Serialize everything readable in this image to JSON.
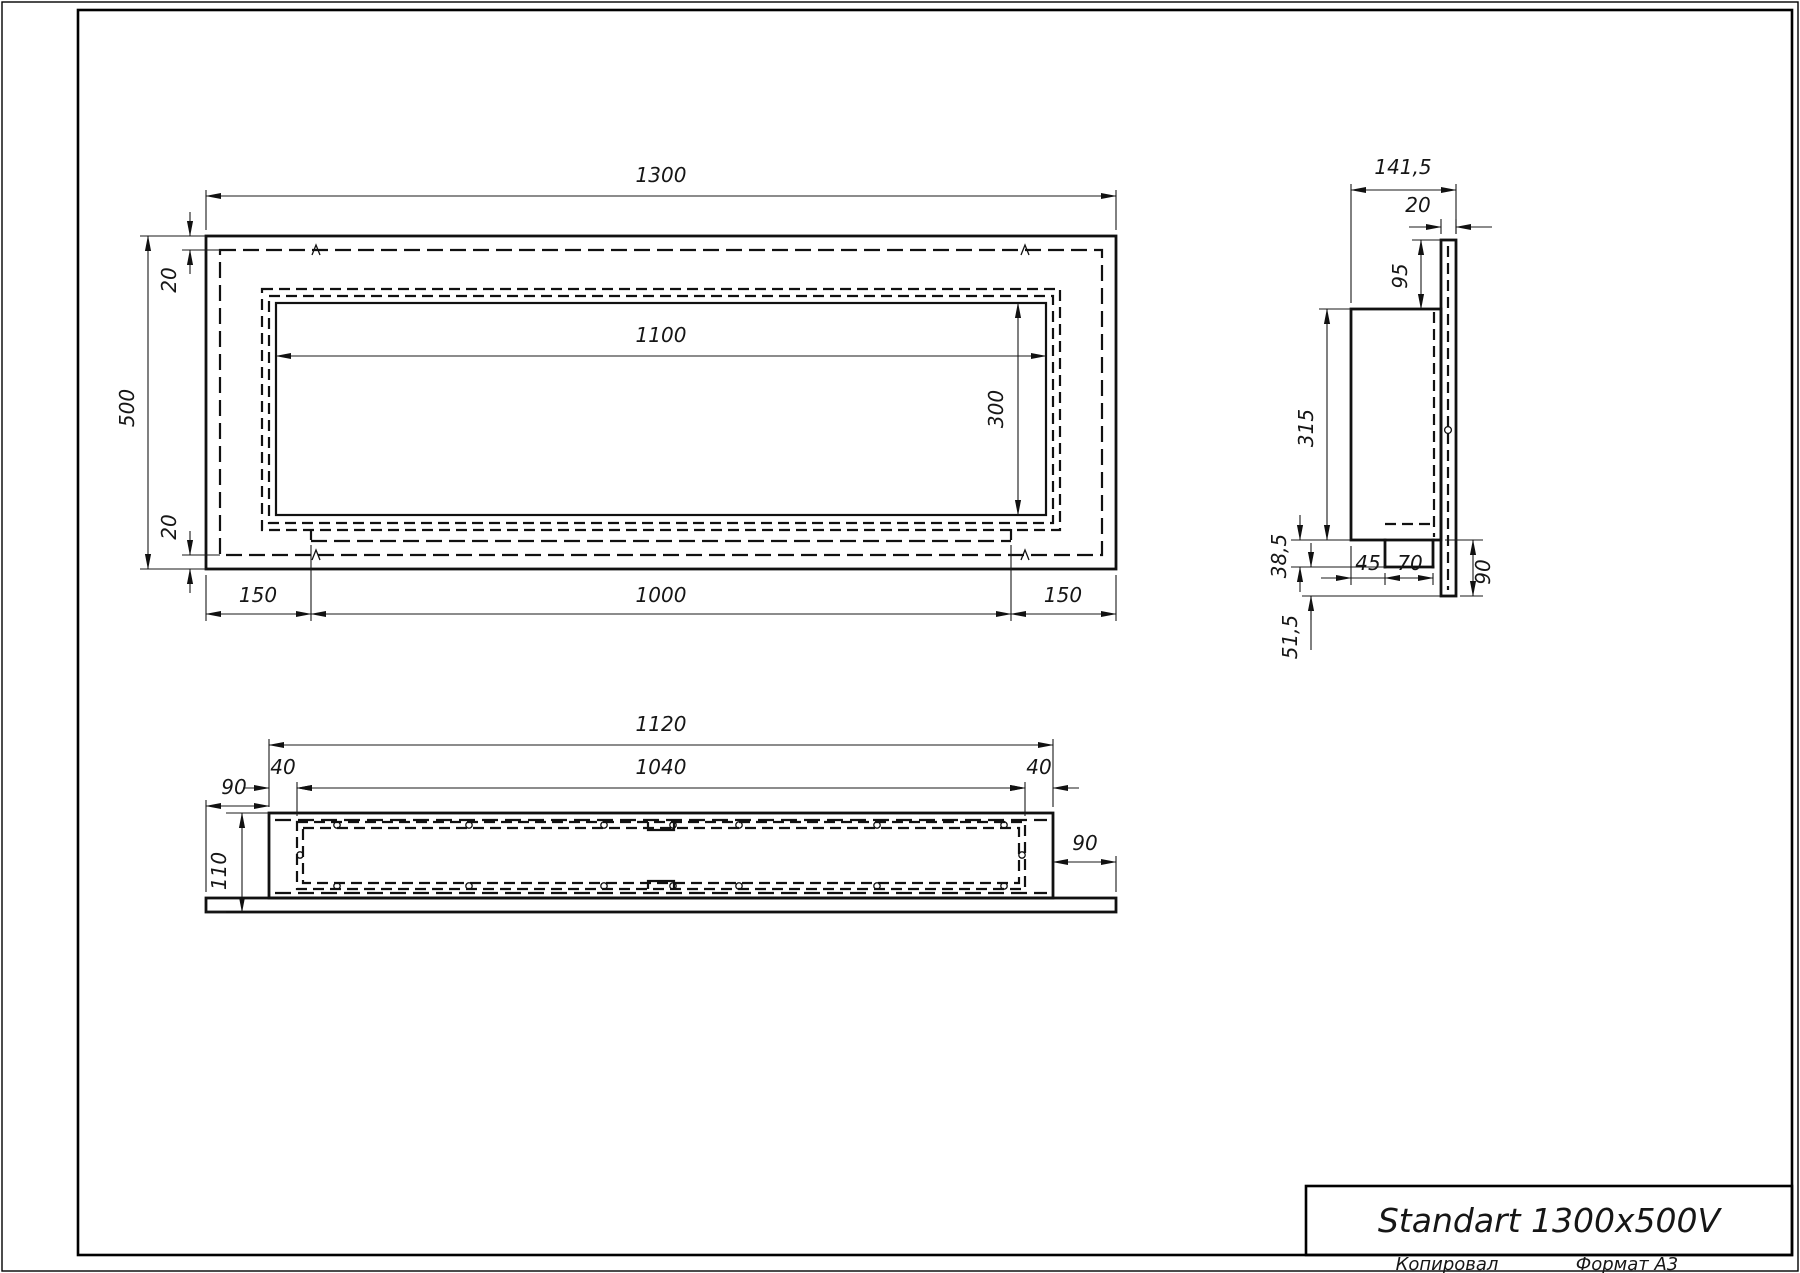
{
  "sheet": {
    "title": "Standart 1300x500V",
    "copied_label": "Копировал",
    "format_label": "Формат А3"
  },
  "front_view": {
    "width": "1300",
    "height": "500",
    "top_margin": "20",
    "bottom_margin": "20",
    "opening_width": "1100",
    "opening_height": "300",
    "left_offset": "150",
    "slot_length": "1000",
    "right_offset": "150"
  },
  "side_view": {
    "total_depth": "141,5",
    "plate_thickness": "20",
    "top_inset": "95",
    "body_height": "315",
    "step_height": "38,5",
    "step_depth_a": "45",
    "step_depth_b": "70",
    "plate_drop": "90",
    "bottom_inset": "51,5"
  },
  "plan_view": {
    "body_width": "1120",
    "opening_width": "1040",
    "left_margin": "40",
    "right_margin": "40",
    "left_overhang": "90",
    "right_overhang": "90",
    "depth": "110"
  }
}
